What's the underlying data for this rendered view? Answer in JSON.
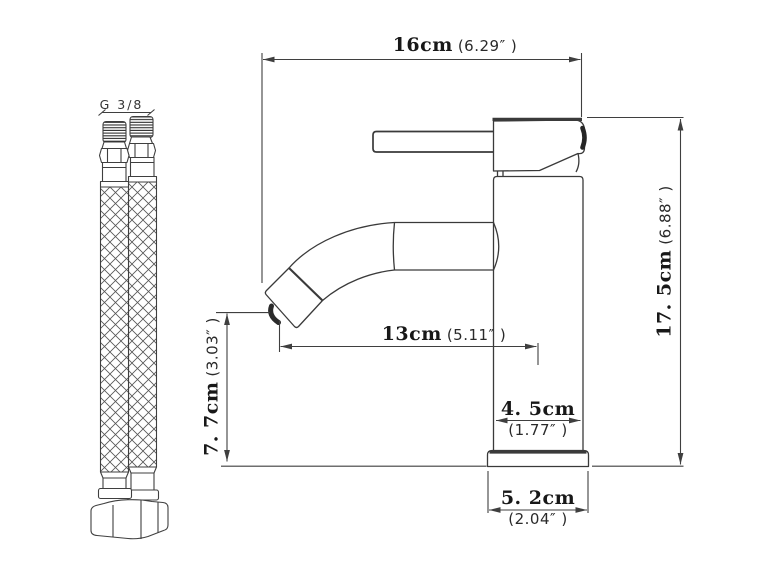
{
  "colors": {
    "background": "#ffffff",
    "line": "#3f3f3f",
    "dark_accent": "#262626",
    "text": "#181818"
  },
  "hose": {
    "thread_label": "G 3/8"
  },
  "dims": {
    "spout_to_back": {
      "cm": "16cm",
      "inch": "(6.29″ )"
    },
    "total_height": {
      "cm": "17. 5cm",
      "inch": "(6.88″ )"
    },
    "spout_height": {
      "cm": "7. 7cm",
      "inch": "(3.03″ )"
    },
    "spout_reach": {
      "cm": "13cm",
      "inch": "(5.11″ )"
    },
    "body_diameter": {
      "cm": "4. 5cm",
      "inch": "(1.77″ )"
    },
    "base_diameter": {
      "cm": "5. 2cm",
      "inch": "(2.04″ )"
    }
  }
}
